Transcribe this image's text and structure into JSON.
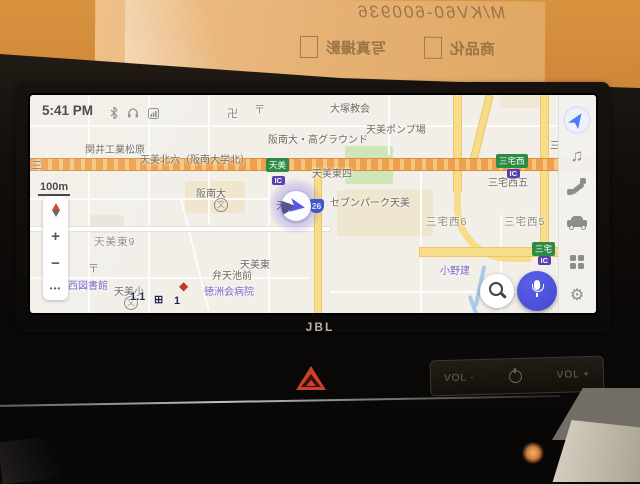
{
  "backdrop": {
    "sign": {
      "handwritten": "M/KV60-600936",
      "checkbox_items": [
        "商品化",
        "写真撮影"
      ]
    }
  },
  "screen": {
    "statusbar": {
      "time": "5:41 PM",
      "icons": [
        "bluetooth",
        "headset",
        "cellular"
      ]
    },
    "controls": {
      "scale": "100m",
      "zoom_in": "+",
      "zoom_out": "−",
      "more": "•••"
    },
    "sidebar": {
      "icons": [
        "navigation",
        "media",
        "phone",
        "vehicle",
        "apps",
        "settings"
      ]
    },
    "map": {
      "route_shield": "26",
      "labels": [
        {
          "text": "卍",
          "x": 197,
          "y": 10,
          "cls": "sym"
        },
        {
          "text": "〒",
          "x": 224,
          "y": 6,
          "cls": "sym"
        },
        {
          "text": "大塚教会",
          "x": 300,
          "y": 5,
          "cls": "g"
        },
        {
          "text": "関井工業松原",
          "x": 55,
          "y": 46,
          "cls": "g"
        },
        {
          "text": "天美北六（阪南大学北）",
          "x": 110,
          "y": 56,
          "cls": "g"
        },
        {
          "text": "阪南大・高グラウンド",
          "x": 238,
          "y": 36,
          "cls": "g"
        },
        {
          "text": "天美ポンプ場",
          "x": 336,
          "y": 26,
          "cls": "g"
        },
        {
          "text": "天美東四",
          "x": 282,
          "y": 70,
          "cls": "g"
        },
        {
          "text": "阪南大",
          "x": 166,
          "y": 90,
          "cls": "g"
        },
        {
          "text": "文",
          "x": 184,
          "y": 103,
          "cls": "school"
        },
        {
          "text": "セブンパーク天美",
          "x": 300,
          "y": 99,
          "cls": "g"
        },
        {
          "text": "天美北小",
          "x": 246,
          "y": 102,
          "cls": "g"
        },
        {
          "text": "三宅西6",
          "x": 396,
          "y": 119,
          "cls": "a"
        },
        {
          "text": "三宅西5",
          "x": 474,
          "y": 119,
          "cls": "a"
        },
        {
          "text": "三宅西五",
          "x": 458,
          "y": 79,
          "cls": "g"
        },
        {
          "text": "天美東9",
          "x": 64,
          "y": 139,
          "cls": "a"
        },
        {
          "text": "〒",
          "x": 58,
          "y": 165,
          "cls": "sym"
        },
        {
          "text": "西図書館",
          "x": 38,
          "y": 182,
          "cls": "p"
        },
        {
          "text": "天美小",
          "x": 84,
          "y": 188,
          "cls": "g"
        },
        {
          "text": "文",
          "x": 94,
          "y": 201,
          "cls": "school"
        },
        {
          "text": "◆",
          "x": 149,
          "y": 184,
          "cls": "red"
        },
        {
          "text": "徳洲会病院",
          "x": 174,
          "y": 188,
          "cls": "p"
        },
        {
          "text": "弁天池前",
          "x": 182,
          "y": 172,
          "cls": "g"
        },
        {
          "text": "天美東",
          "x": 210,
          "y": 161,
          "cls": "g"
        },
        {
          "text": "小野建",
          "x": 410,
          "y": 167,
          "cls": "p"
        },
        {
          "text": "三",
          "x": 520,
          "y": 42,
          "cls": "g"
        },
        {
          "text": "三",
          "x": 2,
          "y": 62,
          "cls": "g"
        },
        {
          "text": "1.1",
          "x": 100,
          "y": 196,
          "cls": "dark"
        },
        {
          "text": "⊞",
          "x": 124,
          "y": 198,
          "cls": "dark"
        },
        {
          "text": "1",
          "x": 144,
          "y": 200,
          "cls": "dark"
        },
        {
          "text": "天美",
          "x": 236,
          "y": 63,
          "cls": "bgreen"
        },
        {
          "text": "IC",
          "x": 242,
          "y": 81,
          "cls": "bic"
        },
        {
          "text": "三宅西",
          "x": 466,
          "y": 59,
          "cls": "bgreen"
        },
        {
          "text": "IC",
          "x": 477,
          "y": 74,
          "cls": "bic"
        },
        {
          "text": "三宅",
          "x": 502,
          "y": 147,
          "cls": "bgreen"
        },
        {
          "text": "IC",
          "x": 508,
          "y": 161,
          "cls": "bic"
        }
      ]
    }
  },
  "hardware": {
    "brand": "JBL",
    "vol_down": "VOL -",
    "vol_up": "VOL +"
  }
}
